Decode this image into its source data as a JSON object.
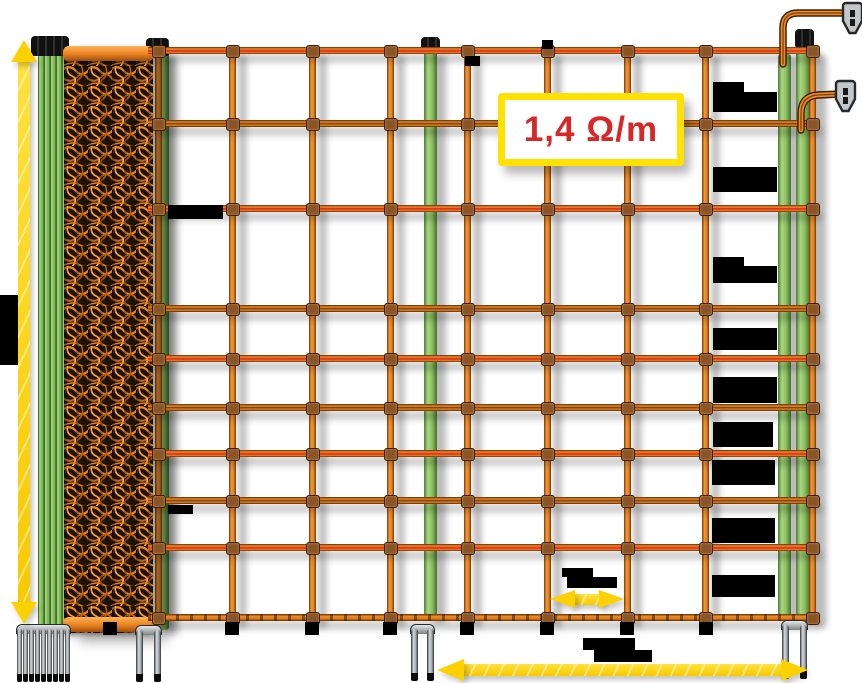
{
  "meta": {
    "description": "Electric fence netting product diagram with orange mesh roll, green posts, double-spike bases, yellow measurement arrows and blacked-out dimension labels"
  },
  "resistance_label": {
    "text": "1,4 Ω/m",
    "x": 498,
    "y": 93,
    "w": 172,
    "h": 59
  },
  "colors": {
    "wire_orange": "#ef8a26",
    "wire_hot_core": "#e03419",
    "mesh_dark": "#1c1206",
    "post_green": "#8cc063",
    "arrow_yellow": "#fdd000",
    "label_red": "#d62828",
    "label_border": "#ffe200",
    "redaction": "#000000",
    "metal": "#c3c7c9"
  },
  "diagram": {
    "canvas": {
      "w": 862,
      "h": 683
    },
    "horizontal_wires": {
      "x1": 148,
      "x2": 816,
      "items": [
        {
          "y": 50,
          "type": "hot"
        },
        {
          "y": 123,
          "type": "cold"
        },
        {
          "y": 208,
          "type": "hot"
        },
        {
          "y": 308,
          "type": "cold"
        },
        {
          "y": 358,
          "type": "hot"
        },
        {
          "y": 407,
          "type": "cold"
        },
        {
          "y": 453,
          "type": "hot"
        },
        {
          "y": 500,
          "type": "cold"
        },
        {
          "y": 547,
          "type": "hot"
        },
        {
          "y": 617,
          "type": "ground"
        }
      ]
    },
    "vertical_strands": {
      "y1": 50,
      "y2": 621,
      "xs": [
        158,
        232,
        312,
        390,
        467,
        547,
        627,
        705,
        812
      ]
    },
    "mesh_roll": {
      "x": 64,
      "y": 46,
      "w": 89,
      "h": 587
    },
    "posts": {
      "bundle": {
        "x": 38,
        "y": 54,
        "w": 28,
        "h": 576,
        "cap": {
          "x": 31,
          "y": 36,
          "w": 38,
          "h": 20
        }
      },
      "roll_edge": {
        "x": 156,
        "y": 52,
        "w": 13,
        "h": 578,
        "cap": {
          "x": 146,
          "y": 38,
          "w": 23,
          "h": 18
        }
      },
      "middle": {
        "x": 424,
        "y": 50,
        "w": 13,
        "h": 568,
        "cap": {
          "x": 421,
          "y": 37,
          "w": 19,
          "h": 16
        }
      },
      "right_a": {
        "x": 778,
        "y": 54,
        "w": 13,
        "h": 566
      },
      "right_b": {
        "x": 796,
        "y": 46,
        "w": 14,
        "h": 574,
        "cap": {
          "x": 795,
          "y": 29,
          "w": 19,
          "h": 18
        }
      }
    },
    "spikes": [
      {
        "x": 17,
        "y": 624,
        "prong_w": 5,
        "gap": 1,
        "count": 9,
        "h": 57
      },
      {
        "x": 136,
        "y": 625,
        "prong_w": 7,
        "gap": 11,
        "count": 2,
        "h": 56
      },
      {
        "x": 411,
        "y": 624,
        "prong_w": 7,
        "gap": 9,
        "count": 2,
        "h": 56
      },
      {
        "x": 782,
        "y": 620,
        "prong_w": 7,
        "gap": 11,
        "count": 2,
        "h": 58
      }
    ],
    "arrows": [
      {
        "name": "height-arrow",
        "dir": "v",
        "cx": 24,
        "y1": 40,
        "y2": 624,
        "shaft": 12,
        "head_w": 27,
        "head_h": 22
      },
      {
        "name": "mesh-spacing-arrow",
        "dir": "h",
        "cy": 599,
        "x1": 550,
        "x2": 624,
        "shaft": 11,
        "head_w": 19,
        "head_h": 25
      },
      {
        "name": "length-arrow",
        "dir": "h",
        "cy": 670,
        "x1": 437,
        "x2": 808,
        "shaft": 12,
        "head_w": 23,
        "head_h": 27
      }
    ],
    "redactions": [
      {
        "x": 0,
        "y": 295,
        "w": 18,
        "h": 70
      },
      {
        "x": 168,
        "y": 205,
        "w": 55,
        "h": 14
      },
      {
        "x": 168,
        "y": 505,
        "w": 25,
        "h": 9
      },
      {
        "x": 713,
        "y": 82,
        "w": 31,
        "h": 12
      },
      {
        "x": 713,
        "y": 92,
        "w": 64,
        "h": 20
      },
      {
        "x": 713,
        "y": 167,
        "w": 64,
        "h": 25
      },
      {
        "x": 713,
        "y": 257,
        "w": 31,
        "h": 12
      },
      {
        "x": 713,
        "y": 266,
        "w": 64,
        "h": 17
      },
      {
        "x": 713,
        "y": 328,
        "w": 64,
        "h": 22
      },
      {
        "x": 713,
        "y": 377,
        "w": 64,
        "h": 26
      },
      {
        "x": 713,
        "y": 422,
        "w": 60,
        "h": 25
      },
      {
        "x": 712,
        "y": 460,
        "w": 63,
        "h": 25
      },
      {
        "x": 712,
        "y": 518,
        "w": 63,
        "h": 25
      },
      {
        "x": 712,
        "y": 575,
        "w": 63,
        "h": 22
      },
      {
        "x": 562,
        "y": 568,
        "w": 31,
        "h": 9
      },
      {
        "x": 567,
        "y": 577,
        "w": 50,
        "h": 11
      },
      {
        "x": 583,
        "y": 638,
        "w": 52,
        "h": 12
      },
      {
        "x": 594,
        "y": 650,
        "w": 58,
        "h": 12
      }
    ],
    "stubs": [
      {
        "x": 103,
        "y": 622,
        "w": 14,
        "h": 13
      },
      {
        "x": 225,
        "y": 622,
        "w": 14,
        "h": 13
      },
      {
        "x": 305,
        "y": 622,
        "w": 14,
        "h": 13
      },
      {
        "x": 383,
        "y": 622,
        "w": 14,
        "h": 13
      },
      {
        "x": 460,
        "y": 622,
        "w": 14,
        "h": 13
      },
      {
        "x": 540,
        "y": 622,
        "w": 14,
        "h": 13
      },
      {
        "x": 620,
        "y": 622,
        "w": 14,
        "h": 13
      },
      {
        "x": 699,
        "y": 622,
        "w": 14,
        "h": 13
      },
      {
        "x": 542,
        "y": 40,
        "w": 11,
        "h": 9
      },
      {
        "x": 465,
        "y": 56,
        "w": 15,
        "h": 10
      }
    ],
    "lead_wires": [
      {
        "path": "M783 64 L783 28 Q783 13 798 13 L850 13"
      },
      {
        "path": "M801 130 L801 114 Q801 96 818 95 L841 94"
      }
    ],
    "clips": [
      {
        "x": 841,
        "y": 2
      },
      {
        "x": 834,
        "y": 80
      }
    ]
  }
}
